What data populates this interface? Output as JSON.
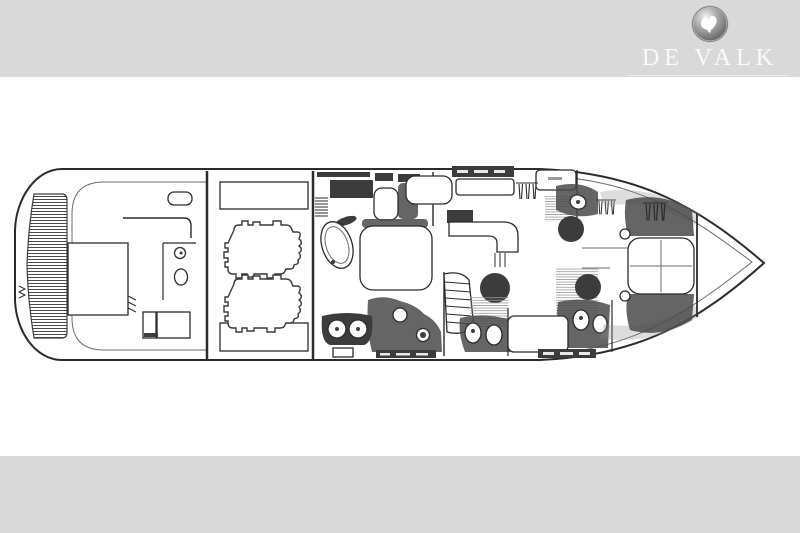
{
  "header": {
    "wordmark": "DE VALK",
    "emblem_icon": "falcon-sphere-icon",
    "banner_color": "#d9d9d9",
    "wordmark_color": "#fafafa",
    "underline_color": "#ececec"
  },
  "footer": {
    "band_color": "#d9d9d9"
  },
  "palette": {
    "background": "#ffffff",
    "line": "#2b2b2b",
    "line_soft": "#6b6b6b",
    "dark_fill": "#3c3c3c",
    "shade": "#8d8d8d",
    "banner": "#d9d9d9",
    "wordmark": "#fafafa",
    "underline": "#ececec"
  },
  "plan": {
    "figure": "motor-yacht-deck-plan",
    "elements": [
      "hull-outline",
      "swim-platform",
      "transom-ladder",
      "aft-deck",
      "wet-bar",
      "aft-day-head",
      "cockpit-benches",
      "engine-room",
      "port-engine",
      "starboard-engine",
      "port-fuel-tank",
      "starboard-fuel-tank",
      "midship-master-cabin",
      "master-bed",
      "bathtub",
      "twin-sink-vanity",
      "companionway-ladder",
      "salon-galley",
      "curved-staircase",
      "lower-head",
      "guest-cabin-port",
      "guest-cabin-starboard",
      "guest-head",
      "wardrobe-hangers",
      "vip-cabin",
      "vip-island-bed",
      "bow-anchor-locker"
    ]
  }
}
